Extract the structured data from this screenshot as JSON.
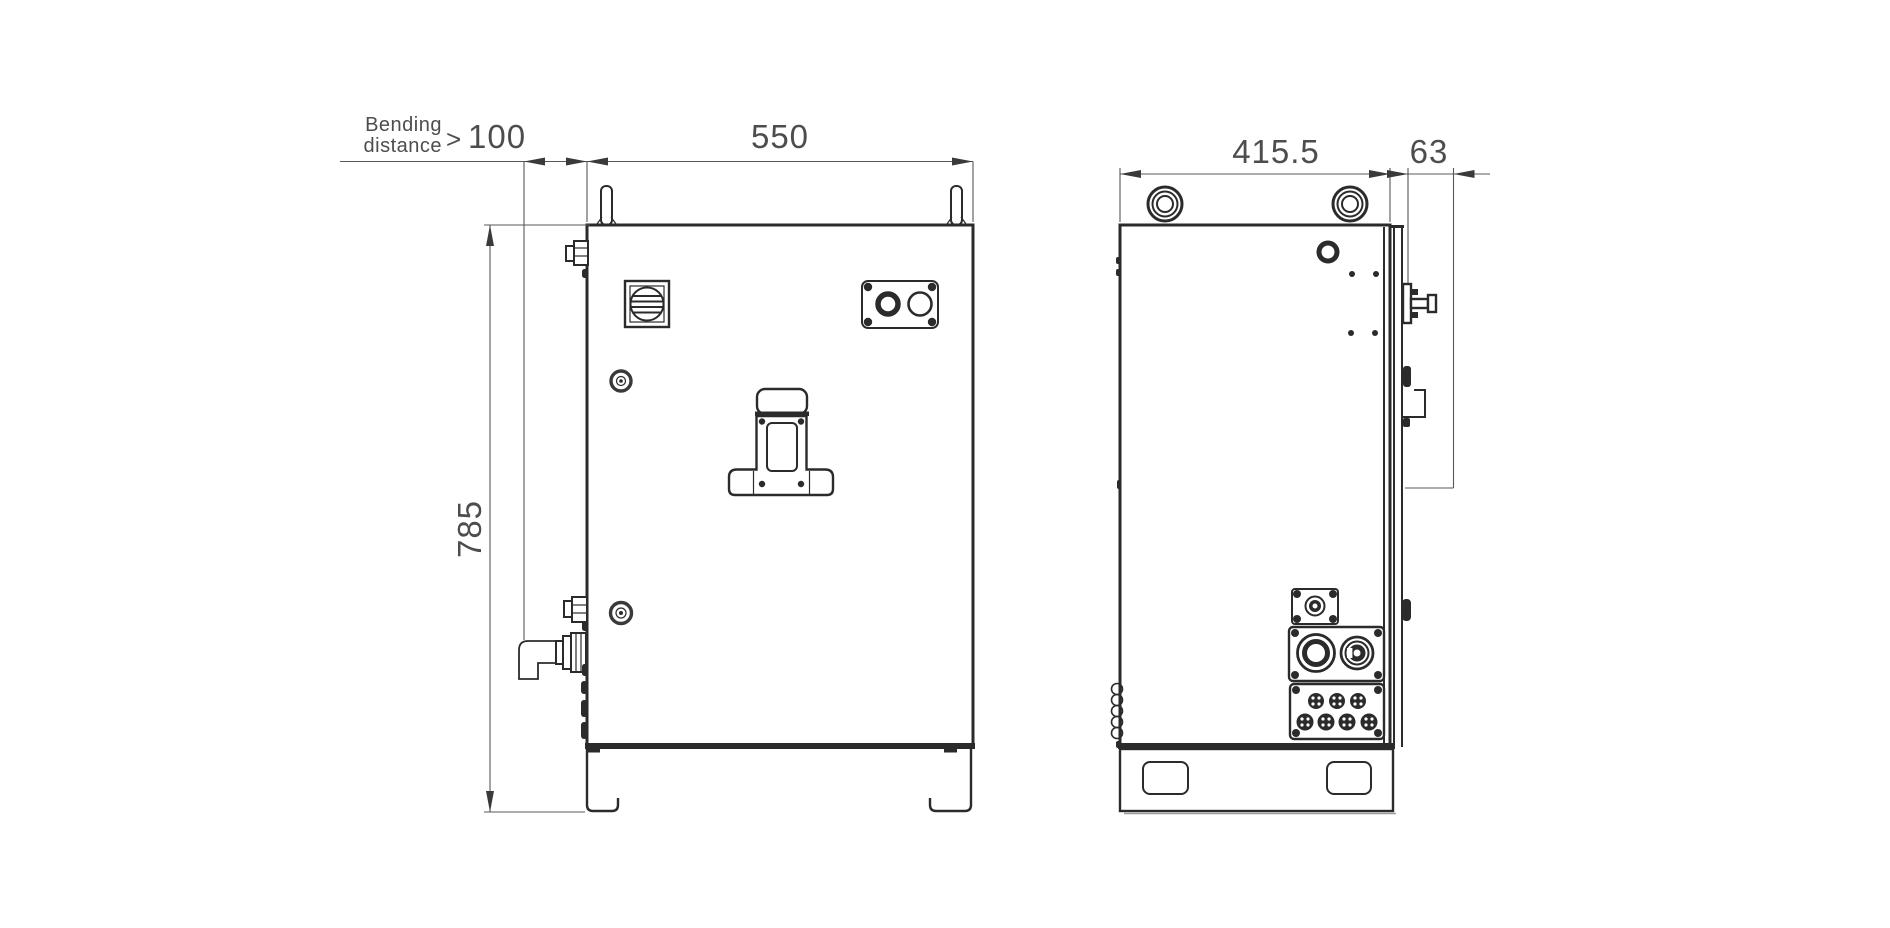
{
  "drawing": {
    "title": "enclosure-dimension-drawing",
    "views": {
      "front_view": "front-view",
      "side_view": "side-view"
    },
    "dimensions": {
      "bending_label_line1": "Bending",
      "bending_label_line2": "distance",
      "bending_operator": ">",
      "bending_value": "100",
      "front_width": "550",
      "front_height": "785",
      "side_depth": "415.5",
      "door_depth": "63"
    },
    "parts": [
      "lifting-pin",
      "lifting-ring",
      "disconnect-switch",
      "push-button-panel",
      "door-handle",
      "hinge-pin",
      "cable-gland",
      "conduit-elbow",
      "connector-panel-small",
      "connector-panel-medium",
      "connector-panel-multi",
      "base-plinth",
      "base-cutout",
      "cable-coil"
    ],
    "colors": {
      "outline": "#2b2b2b",
      "dimension_line": "#585858",
      "text": "#4d4d4d",
      "background": "#ffffff"
    }
  }
}
